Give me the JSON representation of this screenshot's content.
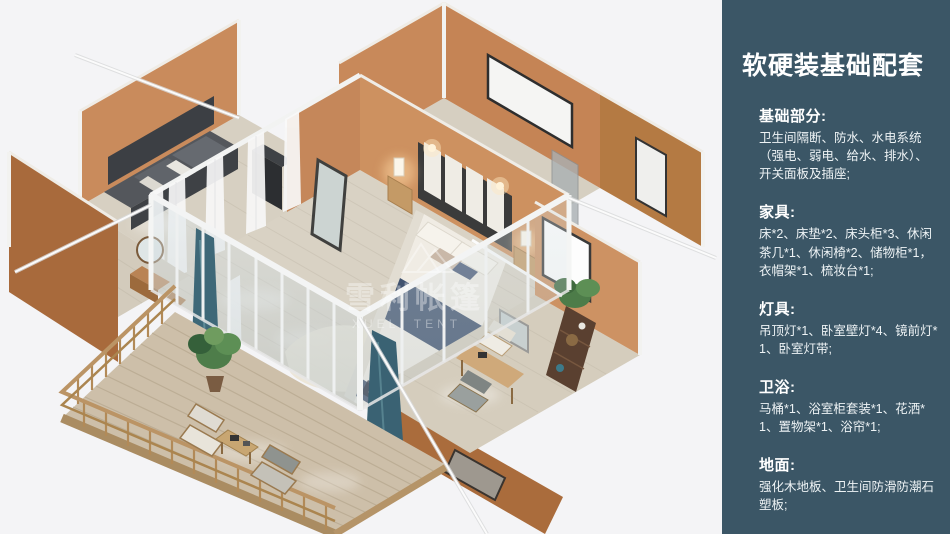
{
  "panel": {
    "title": "软硬装基础配套",
    "bg_color": "#3b5666",
    "text_color": "#ffffff",
    "sections": [
      {
        "heading": "基础部分:",
        "body": "卫生间隔断、防水、水电系统（强电、弱电、给水、排水）、开关面板及插座;"
      },
      {
        "heading": "家具:",
        "body": "床*2、床垫*2、床头柜*3、休闲茶几*1、休闲椅*2、储物柜*1，衣帽架*1、梳妆台*1;"
      },
      {
        "heading": "灯具:",
        "body": "吊顶灯*1、卧室壁灯*4、镜前灯*1、卧室灯带;"
      },
      {
        "heading": "卫浴:",
        "body": "马桶*1、浴室柜套装*1、花洒*1、置物架*1、浴帘*1;"
      },
      {
        "heading": "地面:",
        "body": "强化木地板、卫生间防滑防潮石塑板;"
      }
    ]
  },
  "illustration": {
    "watermark_cn": "雪利帐篷",
    "watermark_en": "XUELI TENT"
  }
}
